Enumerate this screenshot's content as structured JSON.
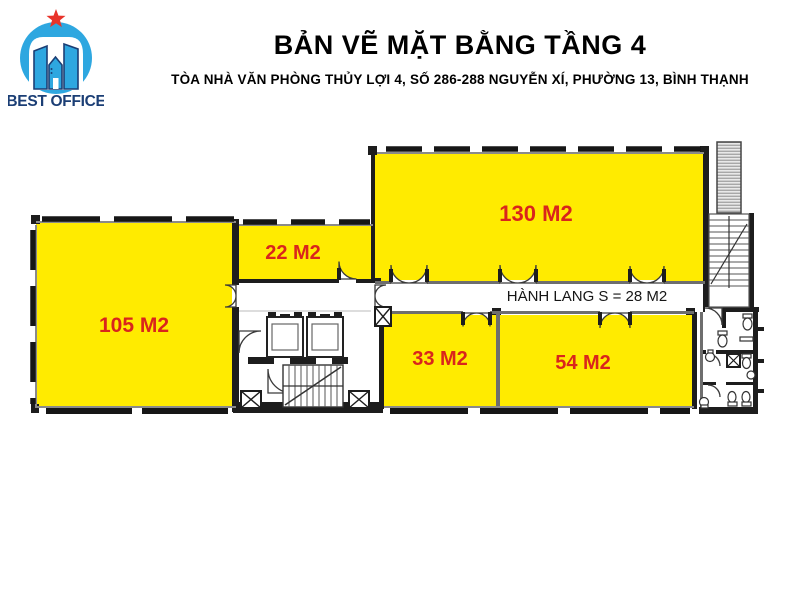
{
  "logo": {
    "text": "BEST OFFICE"
  },
  "header": {
    "title": "BẢN VẼ MẶT BẰNG TẦNG 4",
    "subtitle": "TÒA NHÀ VĂN PHÒNG THỦY LỢI 4, SỐ 286-288 NGUYỄN XÍ, PHƯỜNG 13, BÌNH THẠNH"
  },
  "plan": {
    "corridor_label": "HÀNH LANG S = 28 M2",
    "rooms": [
      {
        "id": "105",
        "label": "105 M2"
      },
      {
        "id": "22",
        "label": "22 M2"
      },
      {
        "id": "130",
        "label": "130 M2"
      },
      {
        "id": "33",
        "label": "33 M2"
      },
      {
        "id": "54",
        "label": "54 M2"
      }
    ],
    "colors": {
      "room_fill": "#FFEB00",
      "room_label": "#D9251C",
      "wall": "#1D1D1D",
      "logo_blue": "#2EA7E0",
      "logo_navy": "#1B3E75",
      "star_red": "#E8332A"
    }
  }
}
